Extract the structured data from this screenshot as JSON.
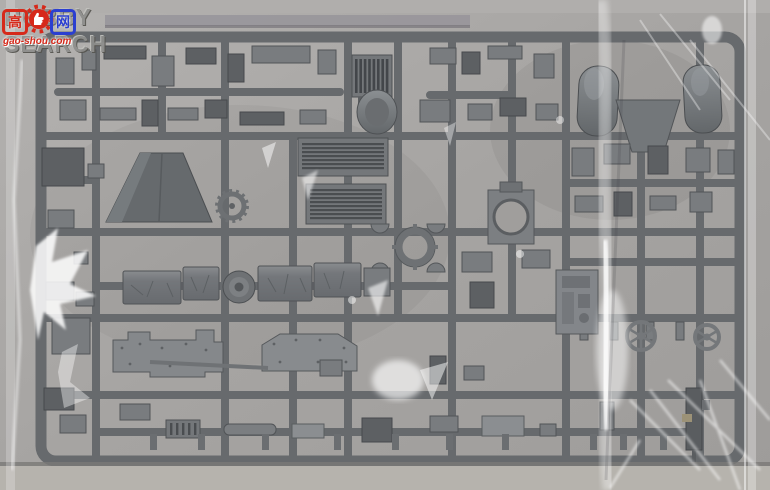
{
  "watermark": {
    "brand_text": "HOBBY SEARCH",
    "logo_char_left": "高",
    "logo_char_right": "网",
    "logo_url_text": "gao-shou.com",
    "brand_color": "#8e8e8c",
    "logo_red": "#d6291a",
    "logo_blue": "#2b3fd0"
  },
  "scene": {
    "subject": "Grey injection-molded model kit sprue sealed in a clear plastic bag",
    "bag_color": "#aba9a7",
    "sprue_color": "#676a6d",
    "part_color_dark": "#5d6063",
    "part_color_light": "#8b8e91",
    "table_color": "#b6b3ad",
    "parts_visible": [
      "radiator-grille",
      "muffler-drum",
      "louvered-engine-deck",
      "louvered-engine-deck-2",
      "gun-shield-trapezoid",
      "turret-ring-plate",
      "ring-part",
      "tarp-covered-stowage-boxes",
      "road-wheel",
      "sprocket-gear",
      "fender-half-left",
      "fender-half-right",
      "hull-side-plate-left",
      "hull-side-plate-right",
      "engine-block",
      "spoked-hand-wheels",
      "machine-gun",
      "assorted-small-fittings"
    ]
  }
}
